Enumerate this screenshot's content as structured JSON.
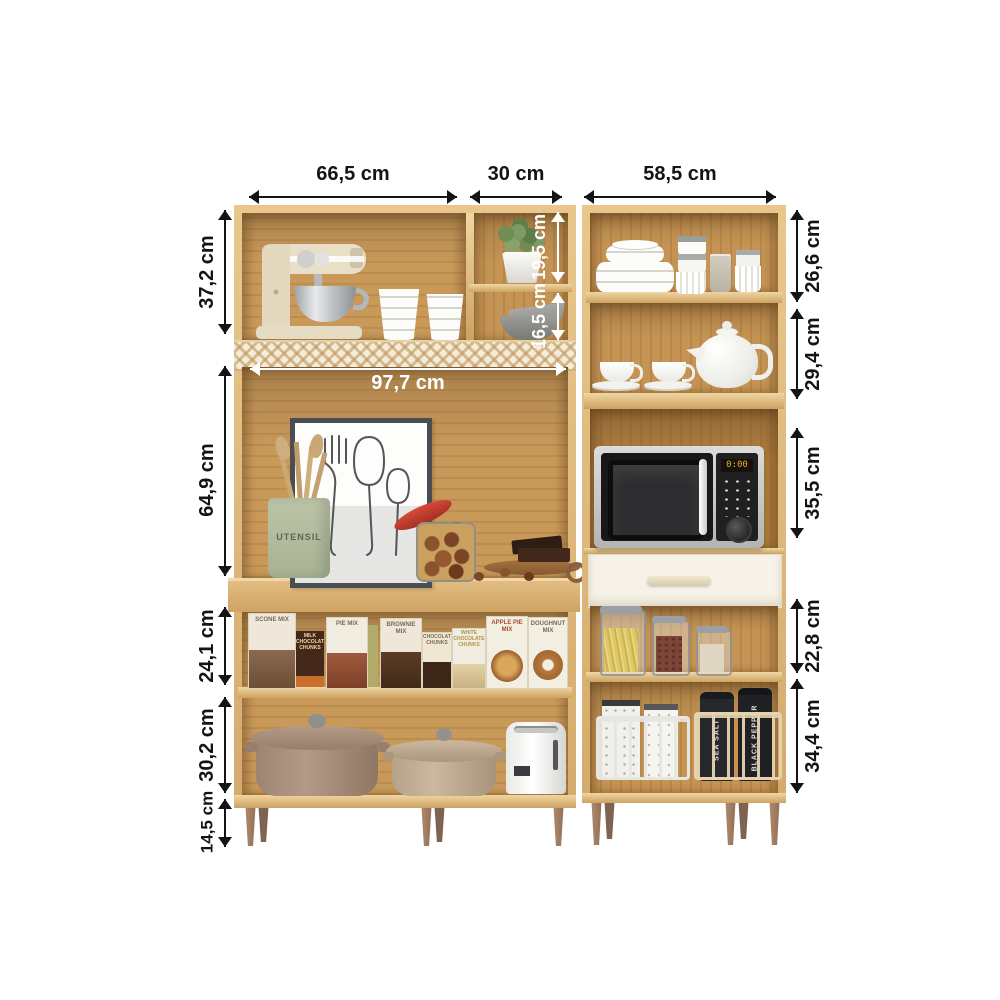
{
  "dims": {
    "top": [
      "66,5 cm",
      "30 cm",
      "58,5 cm"
    ],
    "left": [
      "37,2 cm",
      "64,9 cm",
      "24,1 cm",
      "30,2 cm",
      "14,5 cm"
    ],
    "right": [
      "26,6 cm",
      "29,4 cm",
      "35,5 cm",
      "22,8 cm",
      "34,4 cm"
    ],
    "inner": {
      "upper_shelf": "19,5 cm",
      "lower_shelf": "16,5 cm",
      "inner_width": "97,7 cm"
    }
  },
  "labels": {
    "utensil_crock": "UTENSIL",
    "microwave_display": "0:00",
    "boxes": [
      "SCONE MIX",
      "MILK CHOCOLATE CHUNKS",
      "PIE MIX",
      "BROWNIE MIX",
      "CHOCOLATE CHUNKS",
      "WHITE CHOCOLATE CHUNKS",
      "APPLE PIE MIX",
      "DOUGHNUT MIX"
    ],
    "bags": [
      "SEA SALT",
      "BLACK PEPPER"
    ]
  },
  "colors": {
    "wood_front": "#e0bc81",
    "wood_back": "#c9995a",
    "rattan": "#f4ecd9",
    "drawer_front": "#f6f2e7",
    "dimension_label": "#141414",
    "inner_label": "#ffffff",
    "microwave_display": "#f0a93c",
    "leg": "#a5826a"
  }
}
